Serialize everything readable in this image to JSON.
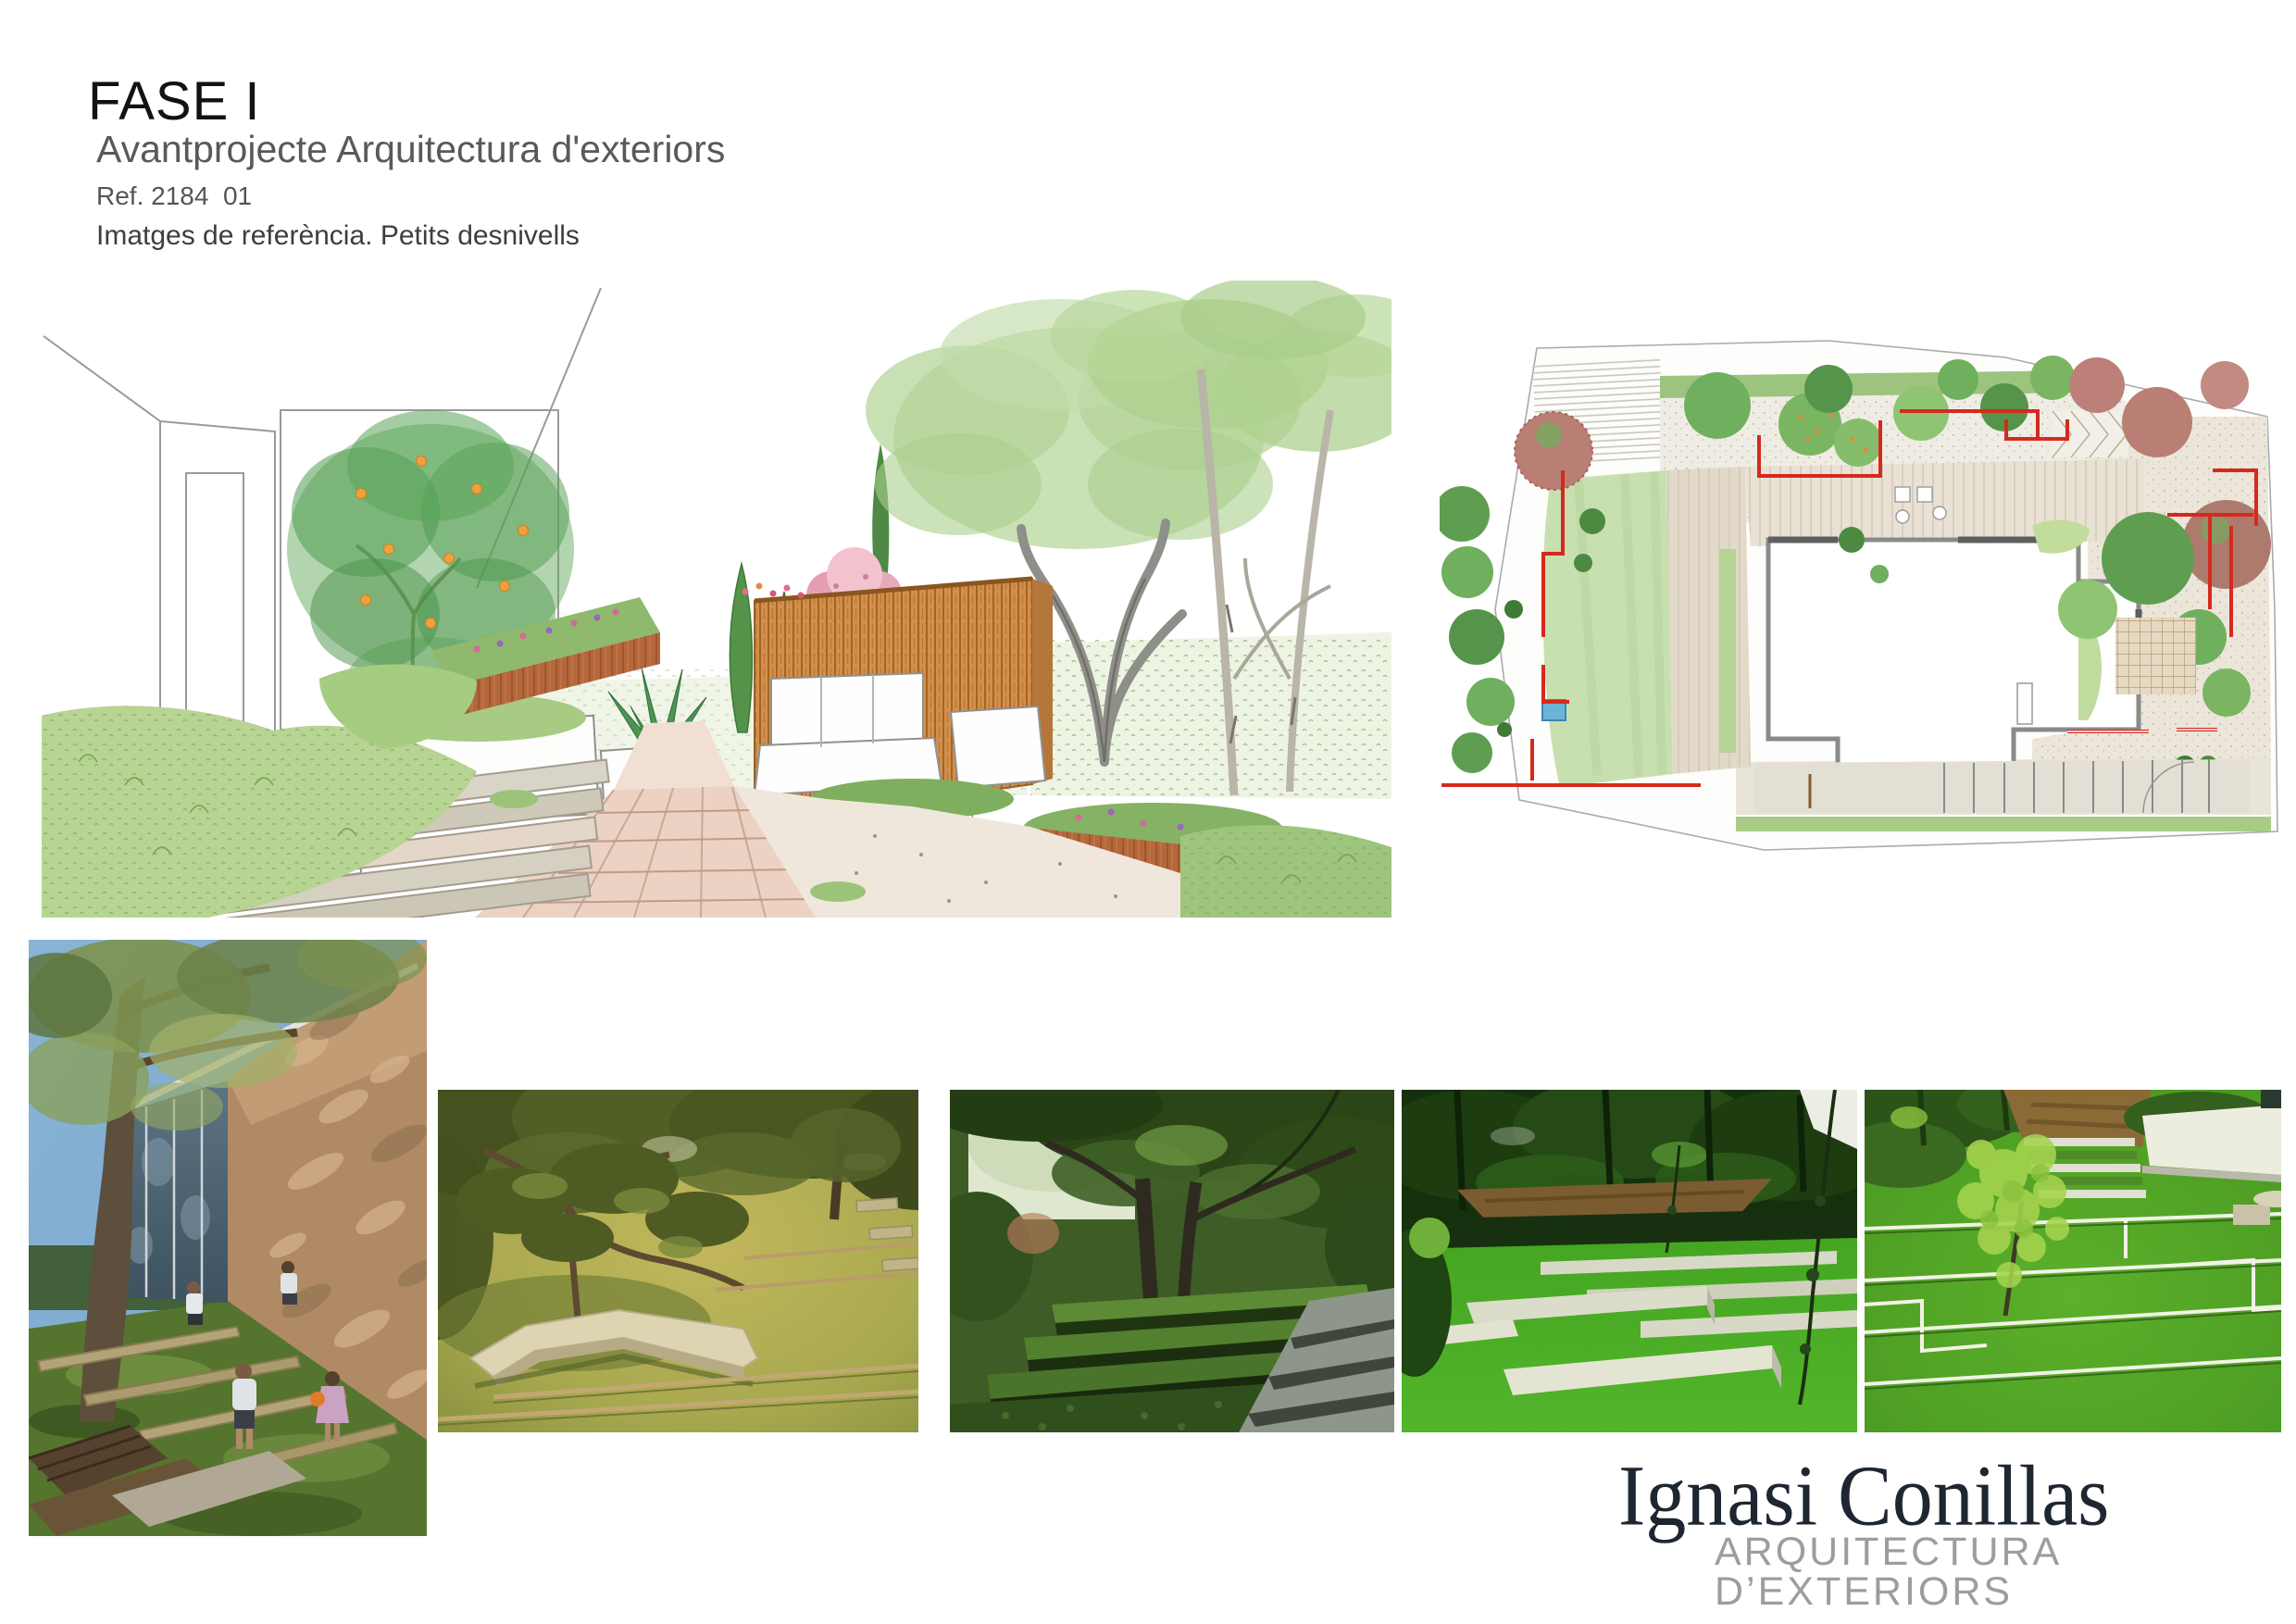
{
  "header": {
    "title": "FASE I",
    "subtitle": "Avantprojecte Arquitectura d'exteriors",
    "reference": "Ref. 2184  01",
    "section_label": "Imatges de referència. Petits desnivells"
  },
  "brand": {
    "name": "Ignasi Conillas",
    "tagline": "ARQUITECTURA D’EXTERIORS"
  },
  "palette": {
    "title_black": "#121212",
    "subtitle_gray": "#595959",
    "section_gray": "#3e3e3e",
    "brand_navy": "#1e2631",
    "brand_tagline_gray": "#9d9d9d",
    "plan_accent_red": "#d42a1e",
    "sketch_slat_wood": "#d28f4e",
    "sketch_corten": "#b5673c",
    "lawn_green": "#3ea31e"
  }
}
